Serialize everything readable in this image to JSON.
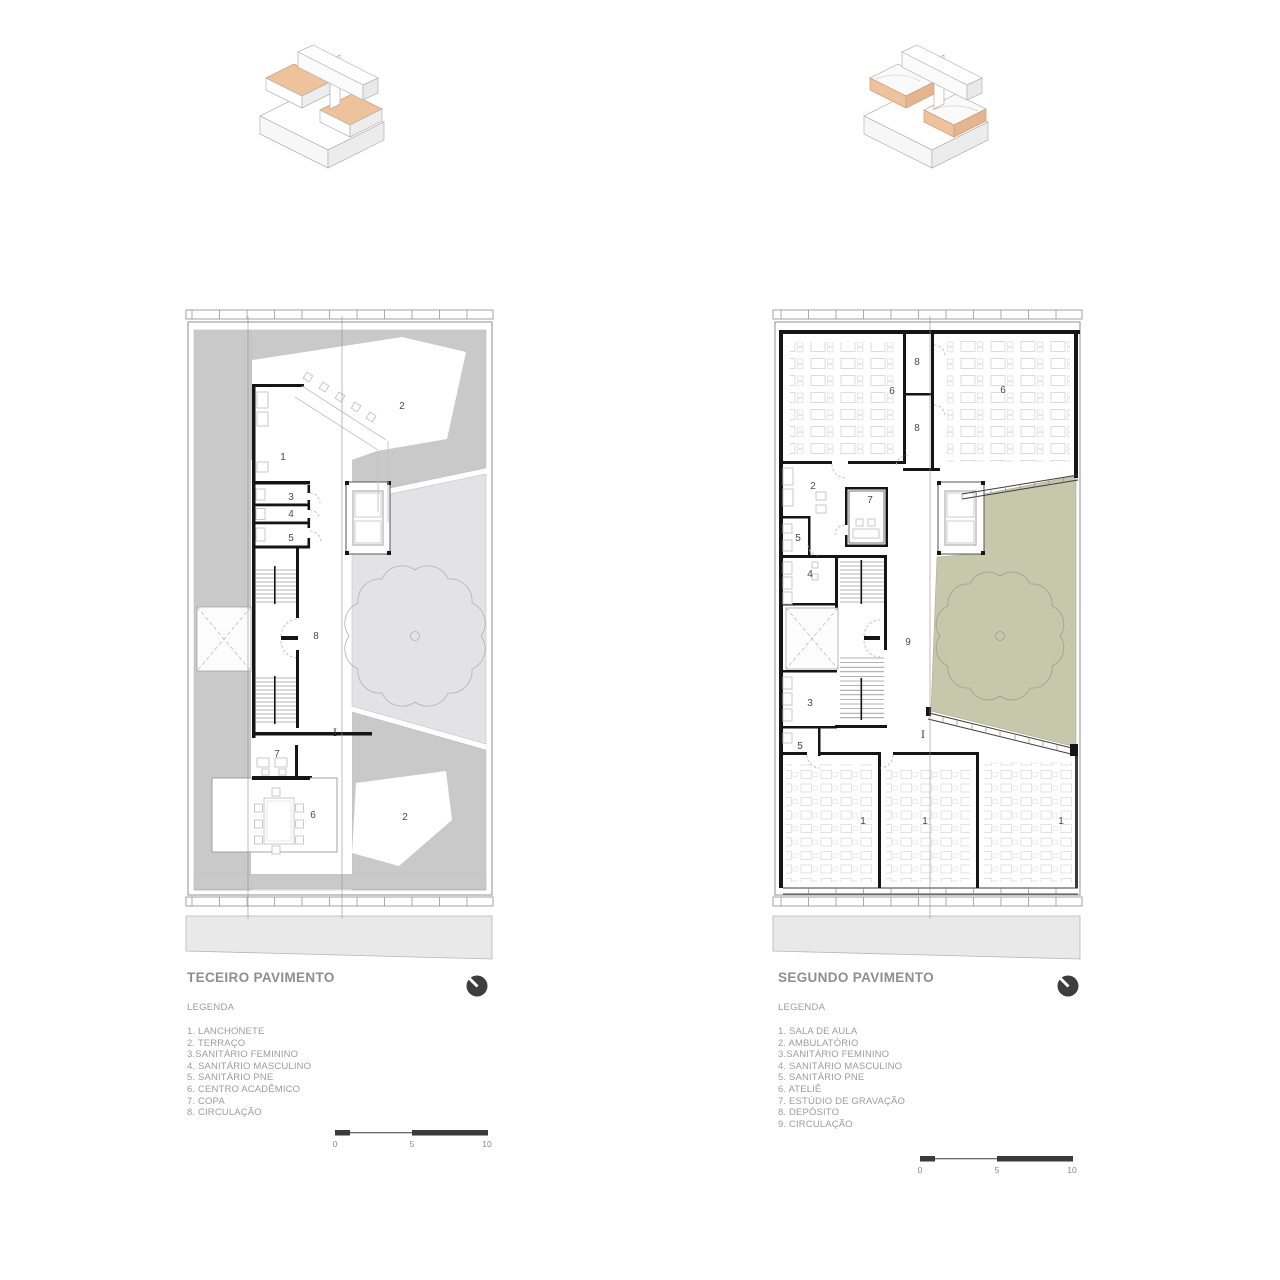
{
  "colors": {
    "terrace_grey": "#c9c9c9",
    "courtyard_grey": "#e3e3e5",
    "courtyard_green": "#c5c8ab",
    "sidewalk_grey": "#e9e9e9",
    "axon_orange": "#eec29b",
    "wall_black": "#151515",
    "title_grey": "#8e8e8e",
    "north_arrow": "#3d3d3d"
  },
  "figures": {
    "third_floor": {
      "title": "TECEIRO PAVIMENTO",
      "legend_title": "LEGENDA",
      "legend_items": [
        "1. LANCHONETE",
        "2. TERRAÇO",
        "3.SANITÁRIO FEMININO",
        "4. SANITÁRIO MASCULINO",
        "5. SANITÁRIO PNE",
        "6. CENTRO ACADÊMICO",
        "7. COPA",
        "8. CIRCULAÇÃO"
      ],
      "scale_labels": [
        "0",
        "5",
        "10"
      ],
      "section_label": "I",
      "rooms": {
        "lanchonete": "1",
        "terraco_upper": "2",
        "terraco_lower": "2",
        "sanitario_feminino": "3",
        "sanitario_masculino": "4",
        "sanitario_pne": "5",
        "centro_academico": "6",
        "copa": "7",
        "circulacao": "8"
      }
    },
    "second_floor": {
      "title": "SEGUNDO PAVIMENTO",
      "legend_title": "LEGENDA",
      "legend_items": [
        "1. SALA DE AULA",
        "2. AMBULATÓRIO",
        "3.SANITÁRIO FEMININO",
        "4. SANITÁRIO MASCULINO",
        "5. SANITÁRIO PNE",
        "6. ATELIÊ",
        "7. ESTÚDIO DE GRAVAÇÃO",
        "8. DEPÓSITO",
        "9. CIRCULAÇÃO"
      ],
      "scale_labels": [
        "0",
        "5",
        "10"
      ],
      "section_label": "I",
      "rooms": {
        "sala_de_aula_a": "1",
        "sala_de_aula_b": "1",
        "sala_de_aula_c": "1",
        "ambulatorio": "2",
        "sanitario_feminino": "3",
        "sanitario_masculino": "4",
        "sanitario_pne_a": "5",
        "sanitario_pne_b": "5",
        "atelie_a": "6",
        "atelie_b": "6",
        "estudio_gravacao": "7",
        "deposito_a": "8",
        "deposito_b": "8",
        "circulacao": "9"
      }
    }
  }
}
